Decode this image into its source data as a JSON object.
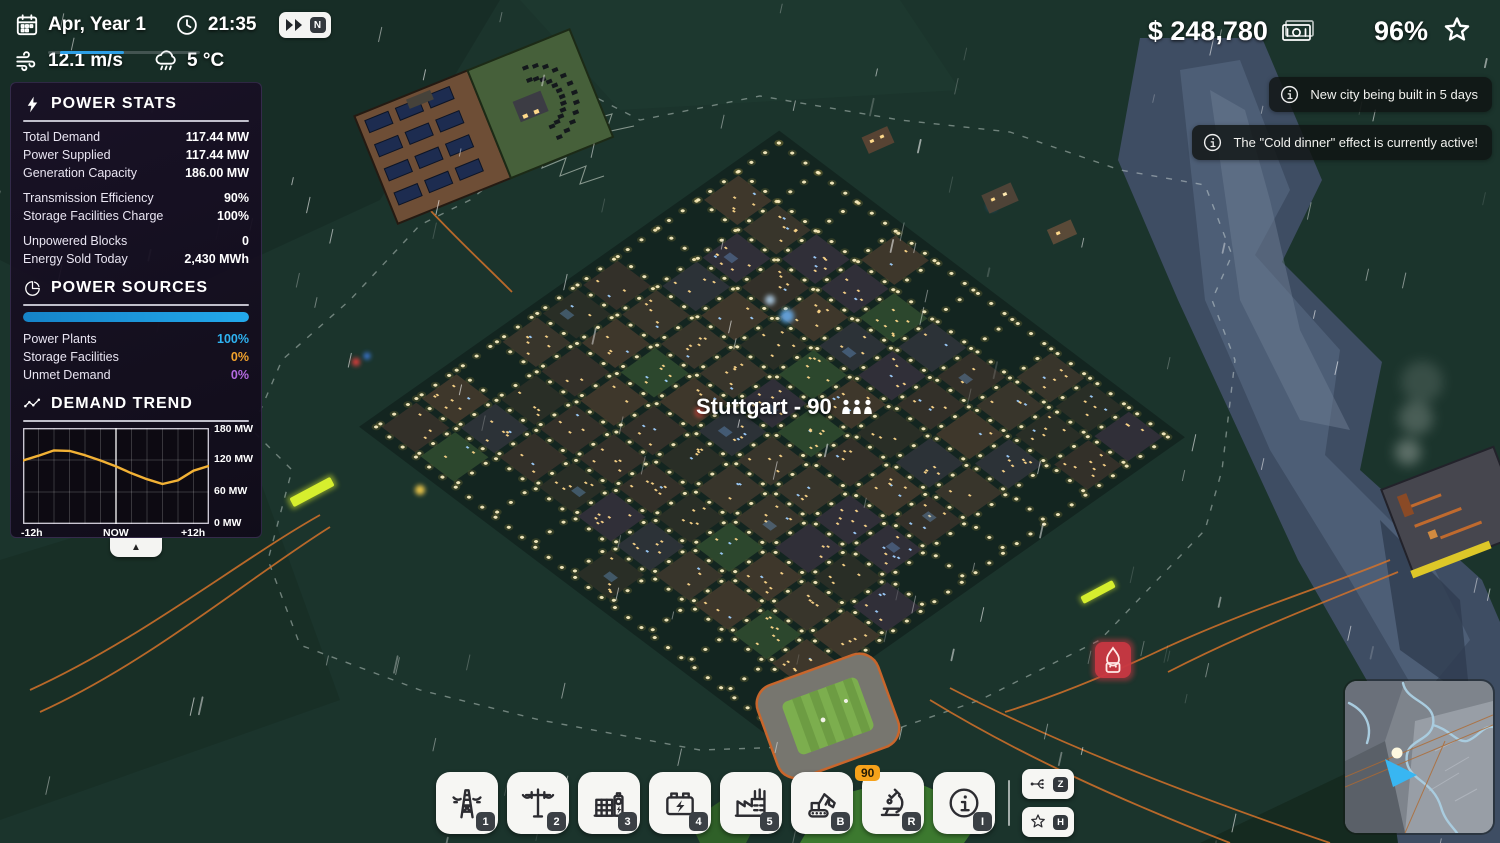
{
  "hud": {
    "date": "Apr, Year 1",
    "time": "21:35",
    "wind": "12.1 m/s",
    "temperature": "5 °C",
    "speed_key": "N",
    "money": "$ 248,780",
    "approval": "96%"
  },
  "notifications": [
    {
      "text": "New city being built in 5 days"
    },
    {
      "text": "The \"Cold dinner\" effect is currently active!"
    }
  ],
  "power_stats": {
    "title": "POWER STATS",
    "rows": [
      {
        "label": "Total Demand",
        "value": "117.44 MW"
      },
      {
        "label": "Power Supplied",
        "value": "117.44 MW"
      },
      {
        "label": "Generation Capacity",
        "value": "186.00 MW"
      },
      {
        "label": "Transmission Efficiency",
        "value": "90%"
      },
      {
        "label": "Storage Facilities Charge",
        "value": "100%"
      },
      {
        "label": "Unpowered Blocks",
        "value": "0"
      },
      {
        "label": "Energy Sold Today",
        "value": "2,430 MWh"
      }
    ]
  },
  "power_sources": {
    "title": "POWER SOURCES",
    "bar_percent": 100,
    "bar_color": "#23a9ec",
    "rows": [
      {
        "label": "Power Plants",
        "value": "100%",
        "color": "#2fb3f2"
      },
      {
        "label": "Storage Facilities",
        "value": "0%",
        "color": "#f2a22c"
      },
      {
        "label": "Unmet Demand",
        "value": "0%",
        "color": "#b express"
      }
    ]
  },
  "demand_trend": {
    "title": "DEMAND TREND",
    "y_labels": [
      "180 MW",
      "120 MW",
      "60 MW",
      "0 MW"
    ],
    "x_labels": [
      "-12h",
      "NOW",
      "+12h"
    ]
  },
  "chart_data": {
    "type": "line",
    "title": "DEMAND TREND",
    "x_hours": [
      -12,
      -10,
      -8,
      -6,
      -4,
      -2,
      0,
      2,
      4,
      6,
      8,
      10,
      12
    ],
    "demand_mw": [
      119,
      128,
      138,
      137,
      129,
      119,
      108,
      95,
      84,
      75,
      82,
      100,
      109
    ],
    "xlabel": "hours relative to now",
    "ylabel": "MW",
    "ylim": [
      0,
      180
    ],
    "y_ticks": [
      "180 MW",
      "120 MW",
      "60 MW",
      "0 MW"
    ],
    "x_ticks": [
      "-12h",
      "NOW",
      "+12h"
    ],
    "line_color": "#f2b135",
    "grid": true,
    "now_marker_x": 0
  },
  "city": {
    "label": "Stuttgart - 90"
  },
  "toolbar": {
    "buttons": [
      {
        "name": "transmission-tower",
        "key": "1"
      },
      {
        "name": "power-pole",
        "key": "2"
      },
      {
        "name": "substation",
        "key": "3"
      },
      {
        "name": "battery-storage",
        "key": "4"
      },
      {
        "name": "power-plant",
        "key": "5"
      },
      {
        "name": "bulldoze",
        "key": "B"
      },
      {
        "name": "research",
        "key": "R",
        "badge": "90"
      },
      {
        "name": "info-mode",
        "key": "I"
      }
    ],
    "side_buttons": [
      {
        "name": "connections",
        "key": "Z"
      },
      {
        "name": "achievements",
        "key": "H"
      }
    ]
  }
}
